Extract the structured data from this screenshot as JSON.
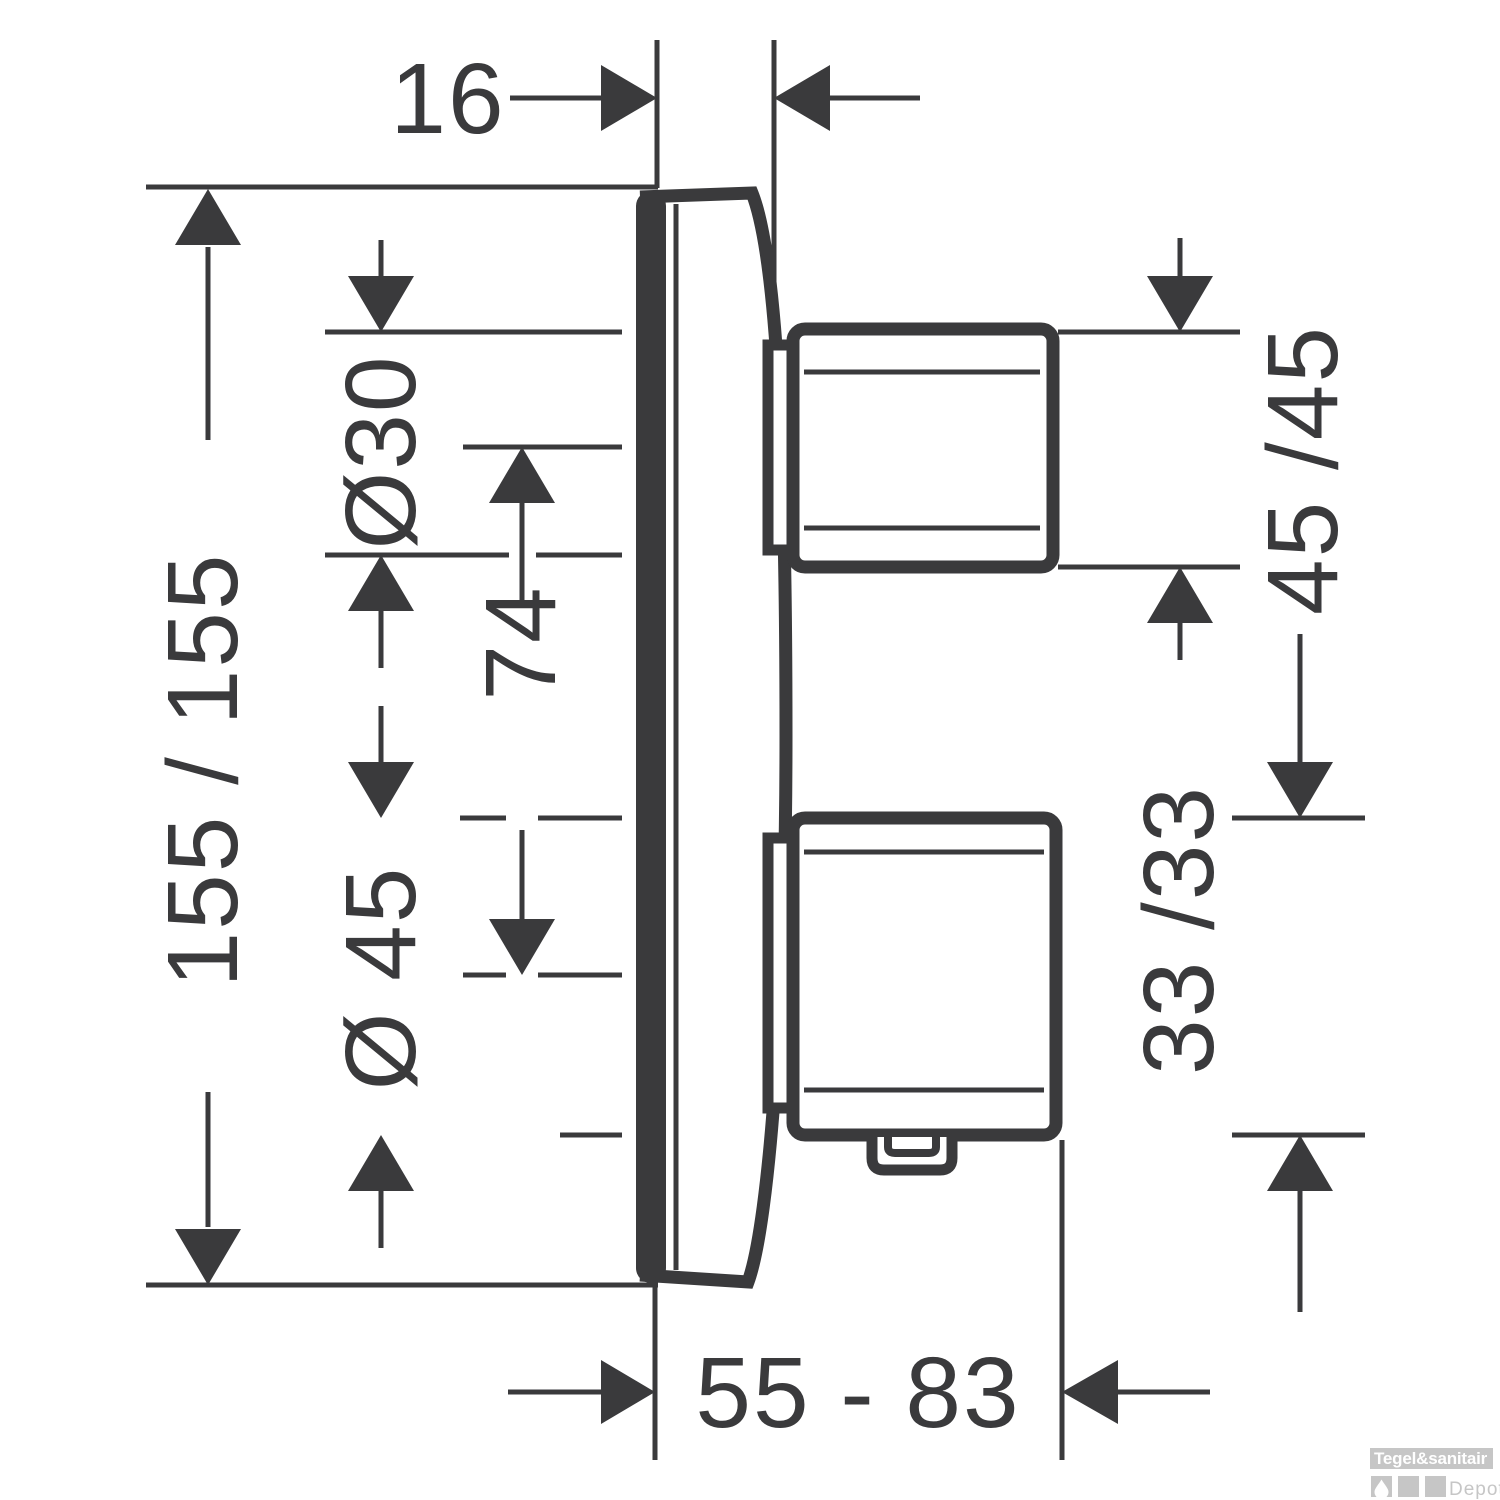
{
  "drawing": {
    "line_color": "#3a3a3c",
    "body_fill": "#ffffff",
    "dimensions": {
      "plate_depth": "16",
      "plate_size": "155 / 155",
      "top_knob_diameter": "Ø30",
      "knob_center_distance": "74",
      "bottom_knob_diameter": "Ø 45",
      "top_handle_size": "45 /45",
      "bottom_handle_size": "33 /33",
      "installation_depth_range": "55 - 83"
    }
  },
  "watermark": {
    "brand_top": "Tegel&sanitair",
    "brand_bottom": "Depot",
    "bar_color": "#c6c6c6",
    "text_color": "#ffffff"
  }
}
